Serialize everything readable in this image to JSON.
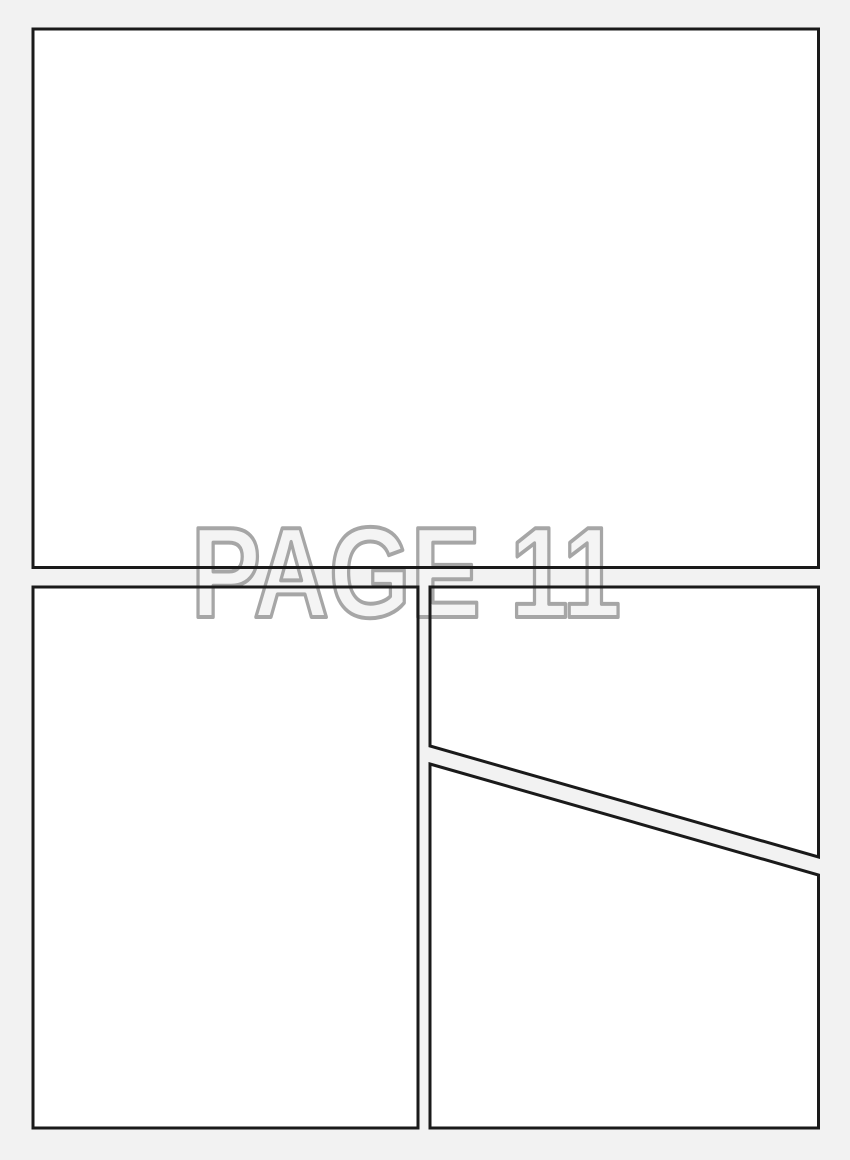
{
  "watermark": {
    "text": "PAGE 11",
    "fill_color": "#f4f4f4",
    "outline_color": "#a6a6a6"
  },
  "colors": {
    "page_background": "#f2f2f2",
    "panel_fill": "#ffffff",
    "panel_border": "#1a1a1a"
  }
}
